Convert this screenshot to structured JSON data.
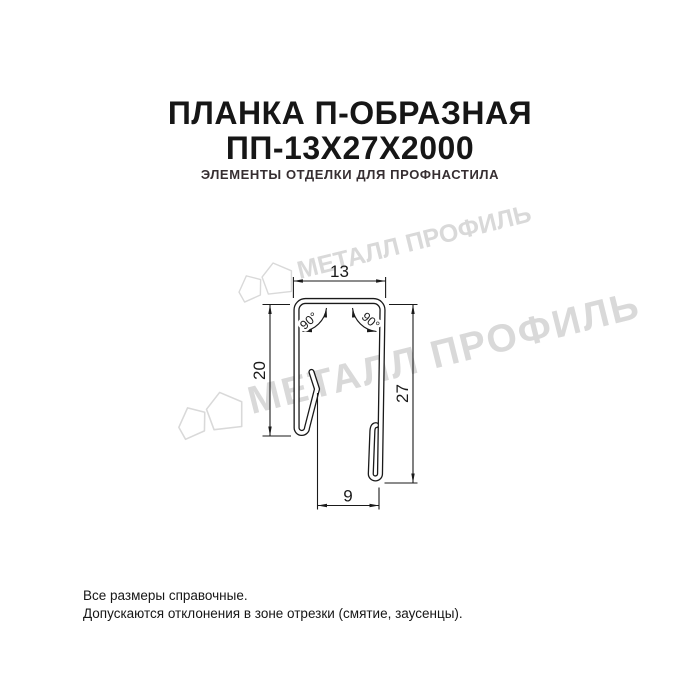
{
  "title": {
    "line1": "ПЛАНКА П-ОБРАЗНАЯ",
    "line2": "ПП-13Х27Х2000",
    "subtitle": "ЭЛЕМЕНТЫ ОТДЕЛКИ ДЛЯ ПРОФНАСТИЛА"
  },
  "watermark": {
    "text": "МЕТАЛЛ ПРОФИЛЬ",
    "color": "#d9d9d9"
  },
  "drawing": {
    "dims": {
      "top_width": "13",
      "left_height": "20",
      "right_height": "27",
      "bottom_width": "9",
      "angle_left": "90°",
      "angle_right": "90°"
    },
    "line_color": "#1a1a1a"
  },
  "footer": {
    "line1": "Все размеры справочные.",
    "line2": "Допускаются отклонения в зоне отрезки (смятие, заусенцы)."
  }
}
